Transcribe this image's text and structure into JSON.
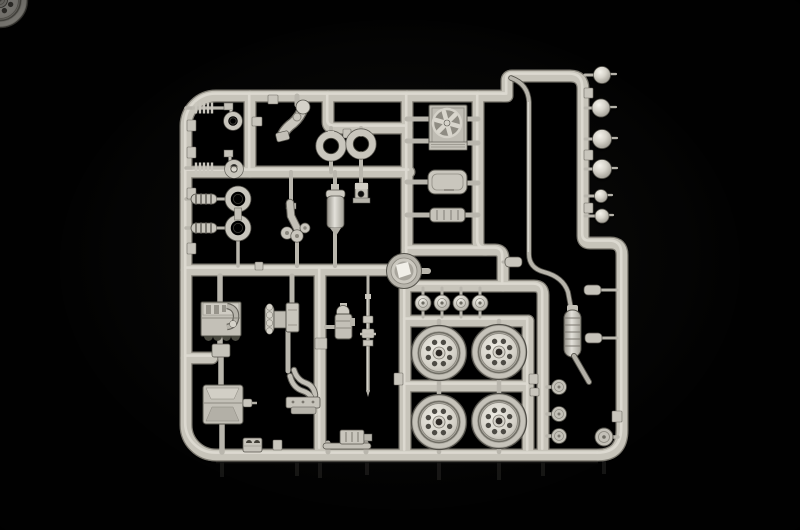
{
  "scene": {
    "type": "photograph",
    "subject": "Unassembled plastic model kit sprue (parts tree) of light-grey vintage car parts photographed on a black background",
    "background_color": "#010101",
    "plastic_color": "#c7c4ba",
    "plastic_highlight": "#eae8e0",
    "plastic_shadow": "#7d7a71",
    "tire_color": "#aeaba2",
    "hole_color": "#4e4c45"
  },
  "sprue": {
    "frame": "rounded rectangular runner frame with internal cross-runners",
    "parts": [
      {
        "id": "headlamp-large",
        "label": "Large headlamp shells",
        "count": 4
      },
      {
        "id": "headlamp-small",
        "label": "Small lamp shells",
        "count": 2
      },
      {
        "id": "radiator-fan",
        "label": "Radiator shell with cooling fan",
        "count": 1
      },
      {
        "id": "seat-pan",
        "label": "Seat pan",
        "count": 1
      },
      {
        "id": "ribbed-crossmember",
        "label": "Ribbed crossmember",
        "count": 1
      },
      {
        "id": "drum-disc",
        "label": "Round drum with bright chrome centre",
        "count": 1
      },
      {
        "id": "intake-ring",
        "label": "Open rings",
        "count": 2
      },
      {
        "id": "drop-arm",
        "label": "Curved pipe arm with round head",
        "count": 1
      },
      {
        "id": "spring-link",
        "label": "Spring tie-rods with eye brackets",
        "count": 2
      },
      {
        "id": "shock-absorber",
        "label": "Coil-spring shock absorbers with eyes",
        "count": 2
      },
      {
        "id": "engine-block",
        "label": "Engine block",
        "count": 1
      },
      {
        "id": "gearbox",
        "label": "Gearbox with flange and lugs",
        "count": 1
      },
      {
        "id": "carburettor",
        "label": "Carburettor / fuel pump",
        "count": 1
      },
      {
        "id": "drive-shaft",
        "label": "Drive shaft with universal joints",
        "count": 1
      },
      {
        "id": "exhaust-manifold",
        "label": "Exhaust manifold with flanges",
        "count": 1
      },
      {
        "id": "fuel-tank",
        "label": "Fuel tank with filler spout",
        "count": 1
      },
      {
        "id": "oil-filter",
        "label": "Cylindrical canister",
        "count": 1
      },
      {
        "id": "suspension-upright",
        "label": "Suspension upright with bosses",
        "count": 1
      },
      {
        "id": "angle-bracket",
        "label": "Angle bracket with hole",
        "count": 1
      },
      {
        "id": "road-wheel",
        "label": "Road wheels with slotted steel rims",
        "count": 4
      },
      {
        "id": "hubcap",
        "label": "Hub caps",
        "count": 4
      },
      {
        "id": "small-disc",
        "label": "Small backing discs",
        "count": 3
      },
      {
        "id": "large-disc",
        "label": "Large backing disc",
        "count": 1
      },
      {
        "id": "exhaust-system",
        "label": "Exhaust down-pipe, silencer and tail pipe",
        "count": 1
      },
      {
        "id": "pipe-clamp",
        "label": "Pipe clamp sleeves",
        "count": 3
      },
      {
        "id": "twin-hole-block",
        "label": "Small twin-hole block",
        "count": 1
      },
      {
        "id": "rack-bracket",
        "label": "Low ribbed rack bracket",
        "count": 1
      }
    ]
  }
}
